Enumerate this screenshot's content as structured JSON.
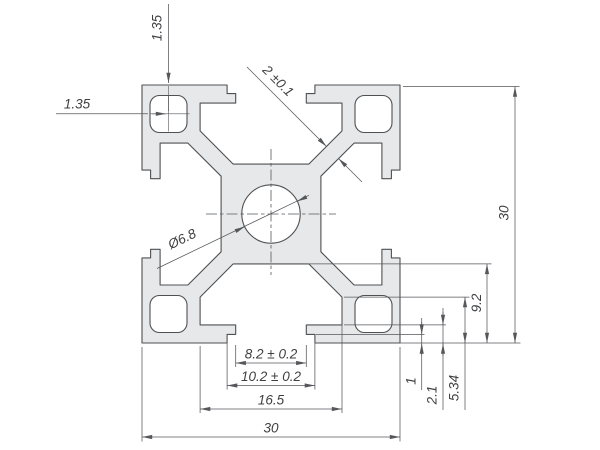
{
  "drawing": {
    "dimensions": {
      "wall_top": "1.35",
      "wall_side": "1.35",
      "web_thickness": "2 ±0.1",
      "center_hole": "Ø6.8",
      "overall_height": "30",
      "overall_width": "30",
      "slot_depth": "9.2",
      "depth_transition": "5.34",
      "depth_lip": "2.1",
      "depth_counterbore": "1",
      "slot_neck_width": "8.2 ± 0.2",
      "slot_recess_width": "10.2 ± 0.2",
      "cavity_width": "16.5"
    },
    "colors": {
      "fill": "#e7e8e9",
      "outline": "#4f5052",
      "dim": "#56575b",
      "text": "#3f4042",
      "bg": "#ffffff"
    }
  }
}
